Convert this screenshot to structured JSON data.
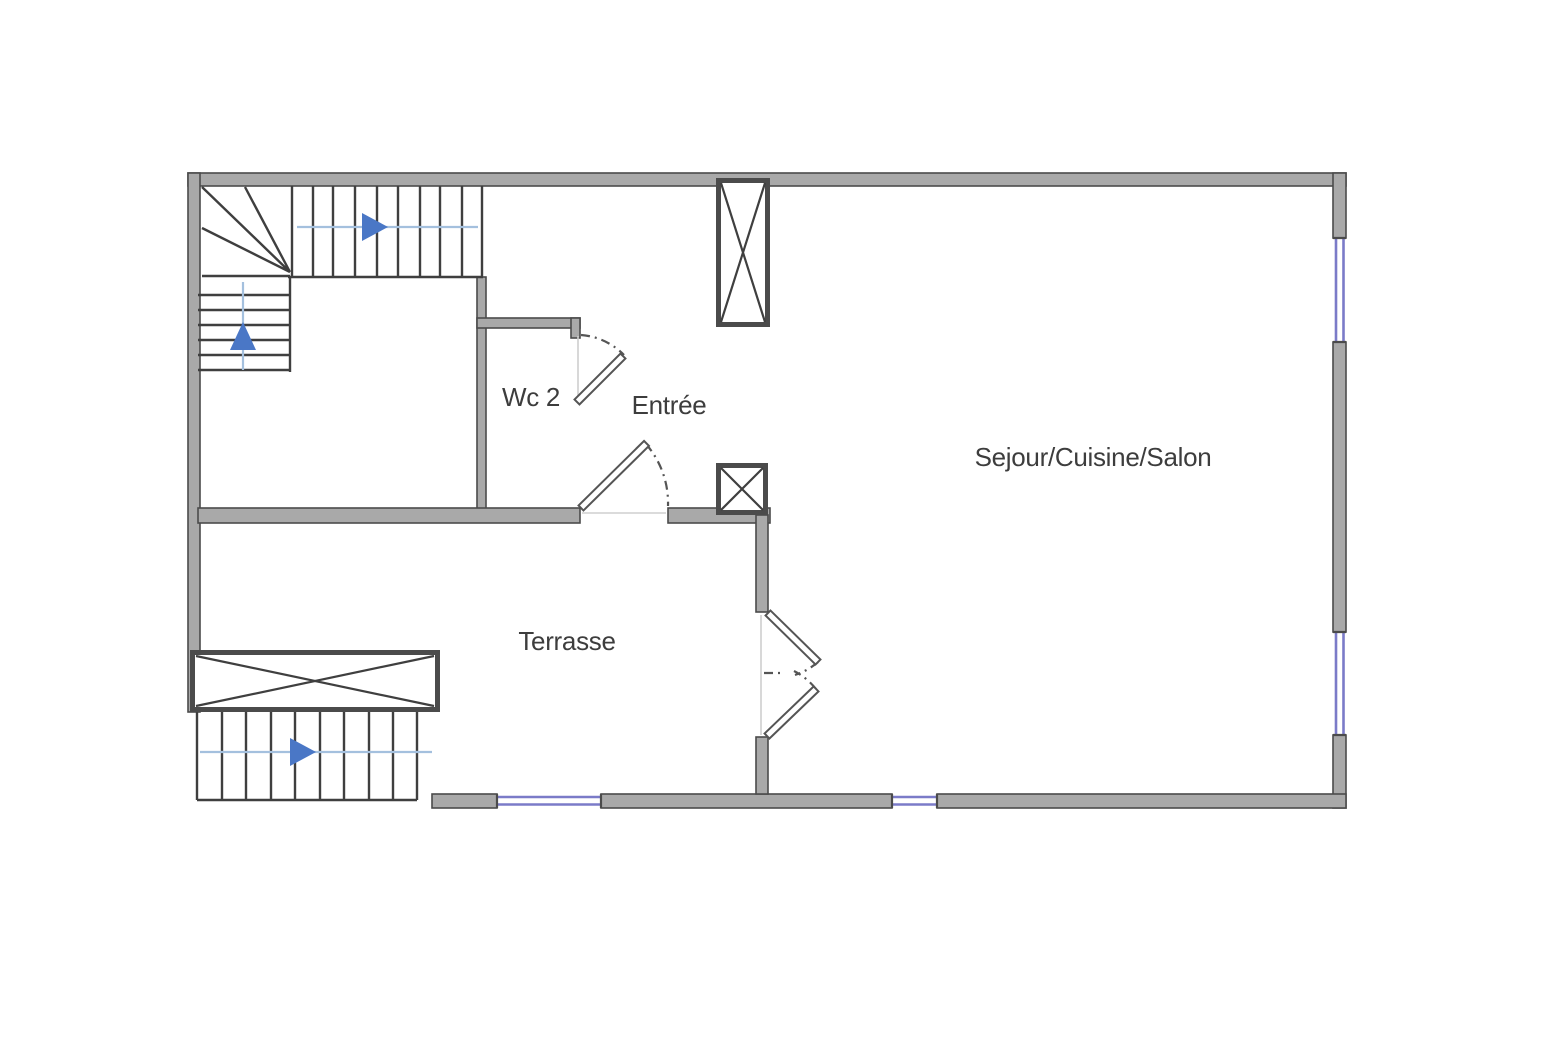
{
  "plan": {
    "rooms": {
      "wc2": {
        "label": "Wc 2"
      },
      "entree": {
        "label": "Entrée"
      },
      "sejour": {
        "label": "Sejour/Cuisine/Salon"
      },
      "terrasse": {
        "label": "Terrasse"
      }
    },
    "colors": {
      "wall_fill": "#a9a9a9",
      "wall_edge": "#4b4b4b",
      "line": "#3f3f3f",
      "window": "#7b7bc8",
      "arrow": "#4a77c6",
      "arrow_line": "#a4c0de",
      "label": "#3d3d3d",
      "background": "#ffffff"
    }
  }
}
